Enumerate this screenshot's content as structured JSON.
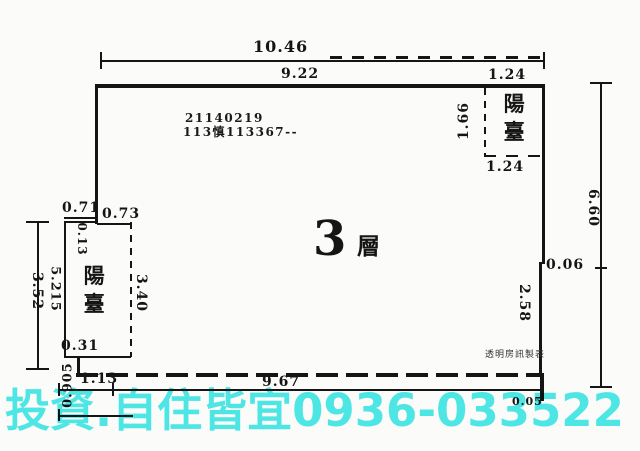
{
  "registry": {
    "line1": "21140219",
    "line2": "113慎113367--"
  },
  "floor": {
    "number": "3",
    "suffix": "層"
  },
  "balconies": {
    "top_right_label": "陽臺",
    "left_label": "陽臺"
  },
  "dims": {
    "top_total": "10.46",
    "top_main": "9.22",
    "top_right_width": "1.24",
    "tr_balcony_depth": "1.66",
    "tr_balcony_width": "1.24",
    "right_height": "6.60",
    "right_notch": "0.06",
    "right_lower": "2.58",
    "bottom_width": "9.67",
    "bottom_corner": "0.05",
    "left_jog_outer": "0.71",
    "left_jog_inner": "0.73",
    "left_wall_thickness": "0.13",
    "left_height_outer": "3.52",
    "left_height_inner": "5.215",
    "left_balcony_height": "3.40",
    "left_step": "0.31",
    "bottom_left_width": "1.13",
    "bottom_left_height": "0.905"
  },
  "credits": {
    "maker": "透明房訊製表"
  },
  "watermark": {
    "text": "投資.自住皆宜0936-033522",
    "color": "#4feaea"
  },
  "colors": {
    "line": "#151515",
    "background": "#fbfbf9"
  }
}
